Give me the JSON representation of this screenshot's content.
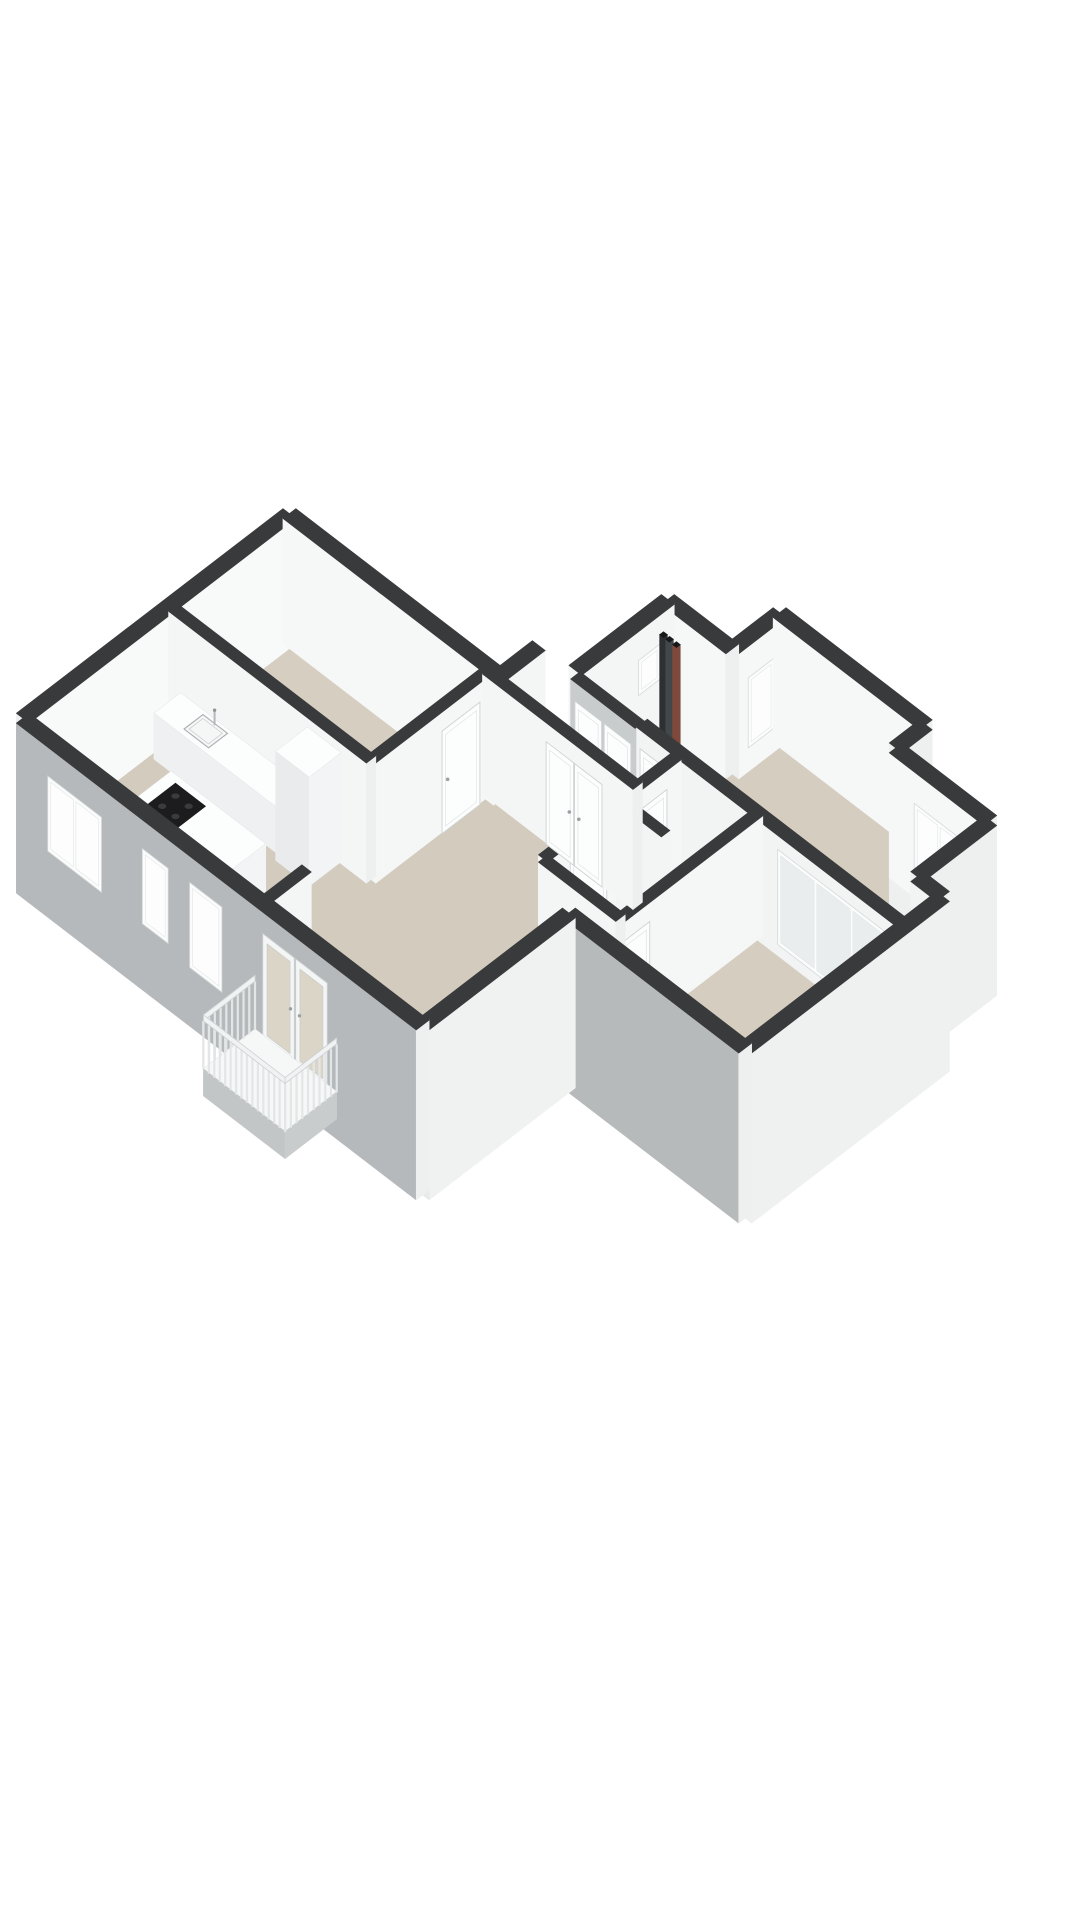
{
  "meta": {
    "background": "#ffffff"
  },
  "colors": {
    "wall_cap": "#393a3c",
    "pipe_cap": "#17191a",
    "interior_face_light": "#f6f7f7",
    "interior_face_gray": "#c9cccd",
    "exterior_face_sw_gray": "#b6b9bb",
    "exterior_face_se_white": "#eff1f1",
    "floor_beige": "#d4cdbf",
    "floor_service": "#e9e7e1",
    "window_frame": "#fbfcfc",
    "window_glass": "#fdfdfe",
    "master_band_glass": "#e9edee",
    "french_glass": "#dbd5c7",
    "door_white": "#fcfdfd",
    "door_edge": "#cfd3d4",
    "handle": "#9aa0a3",
    "cooktop_black": "#1c1c1e",
    "burner": "#3a3b3f",
    "fixture_stroke": "#a9aeb0",
    "railing_slat": "#e3e6e7",
    "railing_rail": "#f0f2f3",
    "railing_rail_edge": "#cdd0d1",
    "pipe_dark": "#2d3032",
    "pipe_mid": "#43474a",
    "pipe_red": "#7e493c",
    "box_top": "#fcfdfd",
    "box_fa": "#f3f4f5",
    "box_fb": "#e9ebec",
    "slab_top": "#f6f7f7",
    "slab_fa": "#c9cccd",
    "slab_fb": "#c3c6c7"
  },
  "proj": {
    "x0": 470,
    "y0": 500,
    "ux": 43,
    "uy": 33,
    "kz": 50
  },
  "scene": {
    "elements": [
      {
        "type": "floor",
        "name": "floor-corridor",
        "fill": "#eae8e2",
        "pts": [
          [
            4.9,
            3.3
          ],
          [
            8.1,
            3.3
          ],
          [
            8.1,
            4.2
          ],
          [
            4.9,
            4.2
          ]
        ]
      },
      {
        "type": "floor",
        "name": "floor-closets",
        "fill": "#e8e6e0",
        "pts": [
          [
            5.7,
            1.1
          ],
          [
            7.2,
            1.1
          ],
          [
            7.2,
            3.25
          ],
          [
            5.7,
            3.25
          ]
        ]
      },
      {
        "type": "floor",
        "name": "floor-bedroom-2",
        "fill": "#d5cec0",
        "pts": [
          [
            7.2,
            0
          ],
          [
            10.6,
            0
          ],
          [
            10.6,
            3.2
          ],
          [
            7.2,
            3.2
          ]
        ]
      },
      {
        "type": "floor",
        "name": "floor-entry-hall",
        "fill": "#d5cec0",
        "pts": [
          [
            10.6,
            0.7
          ],
          [
            12.8,
            0.7
          ],
          [
            12.8,
            3.2
          ],
          [
            10.6,
            3.2
          ]
        ]
      },
      {
        "type": "floor",
        "name": "floor-master-bedroom",
        "fill": "#d5cec0",
        "pts": [
          [
            9.9,
            3.2
          ],
          [
            13.4,
            3.2
          ],
          [
            13.4,
            7.0
          ],
          [
            9.9,
            7.0
          ]
        ]
      },
      {
        "type": "floor",
        "name": "floor-wc",
        "fill": "#e9e7e1",
        "pts": [
          [
            8.1,
            3.3
          ],
          [
            9.9,
            3.3
          ],
          [
            9.9,
            4.6
          ],
          [
            8.1,
            4.6
          ]
        ]
      },
      {
        "type": "floor",
        "name": "floor-bathroom",
        "fill": "#e9e7e1",
        "pts": [
          [
            8.1,
            4.6
          ],
          [
            9.9,
            4.6
          ],
          [
            9.9,
            6.4
          ],
          [
            8.1,
            6.4
          ]
        ]
      },
      {
        "type": "floor",
        "name": "floor-bedroom-left",
        "fill": "#d6cfc1",
        "pts": [
          [
            0,
            4.2
          ],
          [
            4.6,
            4.2
          ],
          [
            4.6,
            6.9
          ],
          [
            0,
            6.9
          ]
        ]
      },
      {
        "type": "floor",
        "name": "floor-living-kitchen",
        "fill": "#d3ccbe",
        "pts": [
          [
            0,
            6.9
          ],
          [
            4.6,
            6.9
          ],
          [
            4.6,
            4.2
          ],
          [
            8.1,
            4.2
          ],
          [
            8.1,
            6.4
          ],
          [
            9.9,
            6.4
          ],
          [
            9.9,
            7.0
          ],
          [
            9.3,
            7.0
          ],
          [
            9.3,
            10.4
          ],
          [
            0,
            10.4
          ]
        ]
      },
      {
        "type": "wall",
        "name": "wall-ext-nw-bedroom2",
        "x1": 7.2,
        "y1": 0,
        "x2": 7.2,
        "y2": 1.1,
        "th": 0.3,
        "h": 2.5,
        "d": 0,
        "side": "#f6f7f7",
        "end": "#eef0f0",
        "windows": [
          {
            "u": 0.3,
            "w": 0.6,
            "z0": 0.5,
            "z1": 1.9,
            "panes": 1,
            "glass": "#fdfdfe"
          }
        ]
      },
      {
        "type": "wall",
        "name": "wall-ext-ne-bedroom2",
        "x1": 7.2,
        "y1": 0,
        "x2": 10.6,
        "y2": 0,
        "th": 0.3,
        "h": 2.5,
        "d": 0,
        "side": "#f6f7f7",
        "end": "#eef0f0"
      },
      {
        "type": "wall",
        "name": "wall-ext-jog-entry",
        "x1": 10.6,
        "y1": 0,
        "x2": 10.6,
        "y2": 0.7,
        "th": 0.3,
        "h": 2.5,
        "d": 0.9,
        "side": "#eef0f0"
      },
      {
        "type": "wall",
        "name": "wall-ext-ne-entry",
        "x1": 10.6,
        "y1": 0.7,
        "x2": 12.8,
        "y2": 0.7,
        "th": 0.3,
        "h": 2.5,
        "d": 0,
        "side": "#f6f7f7",
        "end": "#eef0f0",
        "windows": [
          {
            "u": 0.6,
            "w": 1.15,
            "z0": 0.5,
            "z1": 1.9,
            "panes": 2,
            "glass": "#fdfdfe"
          }
        ]
      },
      {
        "type": "wall",
        "name": "wall-ext-se-entry",
        "x1": 12.8,
        "y1": 0.7,
        "x2": 12.8,
        "y2": 2.4,
        "th": 0.3,
        "h": 2.5,
        "d": 0.9,
        "side": "#eef0f0"
      },
      {
        "type": "wall",
        "name": "wall-ext-ne-master-jog",
        "x1": 12.8,
        "y1": 2.4,
        "x2": 13.4,
        "y2": 2.4,
        "th": 0.3,
        "h": 2.5,
        "d": 0,
        "side": "#f2f3f3",
        "end": "#eef0f0"
      },
      {
        "type": "wall",
        "name": "wall-ext-ne-closets",
        "x1": 5.7,
        "y1": 1.1,
        "x2": 7.2,
        "y2": 1.1,
        "th": 0.3,
        "h": 2.5,
        "d": 0,
        "side": "#f6f7f7",
        "end": "#eef0f0"
      },
      {
        "type": "wall",
        "name": "wall-ext-nw-closets",
        "x1": 5.7,
        "y1": 1.1,
        "x2": 5.7,
        "y2": 3.25,
        "th": 0.3,
        "h": 2.5,
        "d": 0,
        "side": "#f4f5f5",
        "windows": [
          {
            "u": 0.35,
            "w": 0.5,
            "z0": 1.25,
            "z1": 1.95,
            "panes": 1,
            "glass": "#fdfdfe"
          }
        ]
      },
      {
        "type": "pipes",
        "name": "utility-pipes",
        "a": 5.95,
        "b": 1.45,
        "h": 2.25,
        "items": [
          {
            "o": 0,
            "c": "#2d3032"
          },
          {
            "o": 0.14,
            "c": "#43474a"
          },
          {
            "o": 0.3,
            "c": "#7e493c"
          }
        ]
      },
      {
        "type": "wall",
        "name": "wall-ext-nw-west",
        "x1": 0,
        "y1": 4.2,
        "x2": 0,
        "y2": 10.4,
        "th": 0.3,
        "h": 2.5,
        "d": 0,
        "side": "#f8f9f9",
        "end": "#eef0f0"
      },
      {
        "type": "wall",
        "name": "wall-ext-ne-bedroom-left",
        "x1": 0,
        "y1": 4.2,
        "x2": 4.9,
        "y2": 4.2,
        "th": 0.3,
        "h": 2.5,
        "d": 0,
        "side": "#f6f7f7",
        "end": "#eef0f0"
      },
      {
        "type": "wall",
        "name": "wall-ext-jog-corridor",
        "x1": 4.9,
        "y1": 3.3,
        "x2": 4.9,
        "y2": 4.2,
        "th": 0.3,
        "h": 2.5,
        "d": 0,
        "side": "#f4f5f5"
      },
      {
        "type": "wall",
        "name": "wall-closets-corridor",
        "x1": 5.7,
        "y1": 3.25,
        "x2": 7.2,
        "y2": 3.25,
        "th": 0.22,
        "h": 2.4,
        "d": 0,
        "side": "#c9cccd",
        "doors": [
          {
            "u": 0.12,
            "w": 0.62
          },
          {
            "u": 0.8,
            "w": 0.62
          }
        ]
      },
      {
        "type": "wall",
        "name": "wall-bedroom2-corridor",
        "x1": 7.2,
        "y1": 3.2,
        "x2": 13.4,
        "y2": 3.2,
        "th": 0.25,
        "h": 2.4,
        "d": 0,
        "side": "#f2f3f3",
        "doors": [
          {
            "u": 0.1,
            "w": 0.9
          }
        ],
        "windows": [
          {
            "u": 3.3,
            "w": 2.6,
            "z0": 0.25,
            "z1": 2.15,
            "panes": 3,
            "glass": "#e9edee"
          }
        ]
      },
      {
        "type": "wall",
        "name": "wall-wc-bath-west",
        "x1": 8.1,
        "y1": 3.3,
        "x2": 8.1,
        "y2": 6.4,
        "th": 0.22,
        "h": 2.4,
        "d": 0,
        "side": "#f5f6f6",
        "doors": [
          {
            "u": 0.35,
            "w": 0.8
          },
          {
            "u": 1.75,
            "w": 0.85
          }
        ]
      },
      {
        "type": "wall",
        "name": "wall-wc-bath-divider",
        "x1": 8.1,
        "y1": 4.6,
        "x2": 9.15,
        "y2": 4.6,
        "th": 0.2,
        "h": 2.4,
        "d": 0,
        "side": "#f3f4f4"
      },
      {
        "type": "box",
        "name": "wc-basin",
        "a0": 9.38,
        "b0": 3.42,
        "a1": 9.82,
        "b1": 3.86,
        "h": 0.92,
        "top": "#fafbfb",
        "fa": "#f1f3f3",
        "fb": "#e9ecec"
      },
      {
        "type": "sink",
        "name": "wc-basin-bowl",
        "a0": 9.44,
        "b0": 3.48,
        "a1": 9.76,
        "b1": 3.8,
        "z": 0.93
      },
      {
        "type": "faucet",
        "name": "wc-basin-faucet",
        "a": 9.6,
        "b": 3.46,
        "z": 0.92
      },
      {
        "type": "box",
        "name": "bathroom-vanity",
        "a0": 8.4,
        "b0": 5.78,
        "a1": 9.72,
        "b1": 6.3,
        "h": 0.86,
        "top": "#fcfdfd",
        "fa": "#f3f4f5",
        "fb": "#e9ebec"
      },
      {
        "type": "sink",
        "name": "vanity-sink-1",
        "a0": 8.5,
        "b0": 5.84,
        "a1": 9.0,
        "b1": 6.24,
        "z": 0.87
      },
      {
        "type": "sink",
        "name": "vanity-sink-2",
        "a0": 9.1,
        "b0": 5.84,
        "a1": 9.6,
        "b1": 6.24,
        "z": 0.87
      },
      {
        "type": "faucet",
        "name": "vanity-faucet-1",
        "a": 8.75,
        "b": 5.82,
        "z": 0.86
      },
      {
        "type": "faucet",
        "name": "vanity-faucet-2",
        "a": 9.35,
        "b": 5.82,
        "z": 0.86
      },
      {
        "type": "wall",
        "name": "wall-master-west",
        "x1": 9.9,
        "y1": 3.2,
        "x2": 9.9,
        "y2": 7.0,
        "th": 0.22,
        "h": 2.4,
        "d": 0,
        "side": "#f5f6f6",
        "doors": [
          {
            "u": 2.65,
            "w": 0.88
          }
        ]
      },
      {
        "type": "wall",
        "name": "wall-ext-se-master",
        "x1": 13.4,
        "y1": 2.4,
        "x2": 13.4,
        "y2": 7.0,
        "th": 0.3,
        "h": 2.5,
        "d": 0.9,
        "side": "#eff1f1",
        "end": "#eef0f0"
      },
      {
        "type": "wall",
        "name": "wall-bedroom-left-east",
        "x1": 4.6,
        "y1": 4.2,
        "x2": 4.6,
        "y2": 6.9,
        "th": 0.22,
        "h": 2.4,
        "d": 0,
        "side": "#f5f6f6",
        "doors": [
          {
            "u": 0.3,
            "w": 0.88
          }
        ]
      },
      {
        "type": "wall",
        "name": "wall-kitchen-bedroom",
        "x1": 0,
        "y1": 6.9,
        "x2": 4.6,
        "y2": 6.9,
        "th": 0.22,
        "h": 2.4,
        "d": 0,
        "side": "#f4f5f5",
        "end": "#eef0f0"
      },
      {
        "type": "box",
        "name": "kitchen-counter",
        "a0": 0.25,
        "b0": 6.98,
        "a1": 3.2,
        "b1": 7.6,
        "h": 0.92,
        "top": "#fcfdfd",
        "fa": "#f3f4f5",
        "fb": "#eef0f1"
      },
      {
        "type": "sink",
        "name": "kitchen-sink",
        "a0": 0.85,
        "b0": 7.06,
        "a1": 1.42,
        "b1": 7.5,
        "z": 0.93
      },
      {
        "type": "faucet",
        "name": "kitchen-faucet",
        "a": 1.14,
        "b": 7.08,
        "z": 0.92
      },
      {
        "type": "box",
        "name": "kitchen-tall-cabinet",
        "a0": 3.2,
        "b0": 6.98,
        "a1": 3.98,
        "b1": 7.72,
        "h": 2.18,
        "top": "#fcfdfd",
        "fa": "#f3f4f5",
        "fb": "#e9ebec"
      },
      {
        "type": "wall",
        "name": "wall-living-corridor",
        "x1": 4.6,
        "y1": 4.2,
        "x2": 8.1,
        "y2": 4.2,
        "th": 0.22,
        "h": 2.4,
        "d": 0,
        "side": "#f4f5f5",
        "end": "#eef0f0",
        "doors": [
          {
            "u": 1.5,
            "w": 1.3,
            "double": true
          }
        ]
      },
      {
        "type": "box",
        "name": "kitchen-island",
        "a0": 1.35,
        "b0": 8.3,
        "a1": 3.55,
        "b1": 9.3,
        "h": 0.95,
        "top": "#fcfdfd",
        "fa": "#f3f4f5",
        "fb": "#e9ebec"
      },
      {
        "type": "cooktop",
        "name": "cooktop",
        "a0": 1.6,
        "b0": 8.45,
        "a1": 2.3,
        "b1": 9.15,
        "z": 0.97
      },
      {
        "type": "wall",
        "name": "wall-living-stub",
        "x1": 5.5,
        "y1": 9.3,
        "x2": 5.5,
        "y2": 10.4,
        "th": 0.22,
        "h": 2.4,
        "d": 0,
        "side": "#f4f5f5"
      },
      {
        "type": "wall",
        "name": "wall-bath-living-south",
        "x1": 8.1,
        "y1": 6.4,
        "x2": 9.9,
        "y2": 6.4,
        "th": 0.22,
        "h": 2.4,
        "d": 0,
        "side": "#f4f5f5",
        "end": "#eef0f0"
      },
      {
        "type": "wall",
        "name": "wall-ext-sw-master",
        "x1": 9.3,
        "y1": 7.0,
        "x2": 13.4,
        "y2": 7.0,
        "th": 0.3,
        "h": 2.5,
        "d": 0.9,
        "side": "#b7babb",
        "end": "#eef0f0"
      },
      {
        "type": "wall",
        "name": "wall-ext-se-living",
        "x1": 9.3,
        "y1": 7.0,
        "x2": 9.3,
        "y2": 10.4,
        "th": 0.3,
        "h": 2.5,
        "d": 0.9,
        "side": "#f0f2f2",
        "end": "#e8eaea"
      },
      {
        "type": "wall",
        "name": "wall-ext-sw-living-kitchen",
        "x1": 0,
        "y1": 10.4,
        "x2": 9.3,
        "y2": 10.4,
        "th": 0.3,
        "h": 2.5,
        "d": 0.9,
        "side": "#b6b9bb",
        "end": "#eef0f0",
        "windows": [
          {
            "u": 0.75,
            "w": 1.25,
            "z0": 0.45,
            "z1": 1.95,
            "panes": 2,
            "glass": "#fdfdfe"
          },
          {
            "u": 2.95,
            "w": 0.6,
            "z0": 0.45,
            "z1": 1.95,
            "panes": 1,
            "glass": "#fdfdfe"
          },
          {
            "u": 4.05,
            "w": 0.75,
            "z0": 0.3,
            "z1": 2.0,
            "panes": 1,
            "glass": "#fdfdfe"
          }
        ],
        "french": [
          {
            "u": 5.75,
            "w": 1.5,
            "z1": 2.1,
            "glass": "#dbd5c7"
          }
        ]
      },
      {
        "type": "box",
        "name": "balcony-slab",
        "a0": 5.55,
        "b0": 10.55,
        "a1": 7.45,
        "b1": 11.75,
        "z0": -0.5,
        "h": 0.55,
        "top": "#f6f7f7",
        "fa": "#c9cccd",
        "fb": "#c3c6c7"
      },
      {
        "type": "railing",
        "name": "balcony-railing",
        "z1": 1.0,
        "railh": 0.12,
        "step": 0.13,
        "edges": [
          [
            5.55,
            10.55,
            5.55,
            11.75
          ],
          [
            5.55,
            11.75,
            7.45,
            11.75
          ],
          [
            7.45,
            10.55,
            7.45,
            11.75
          ]
        ]
      }
    ]
  }
}
